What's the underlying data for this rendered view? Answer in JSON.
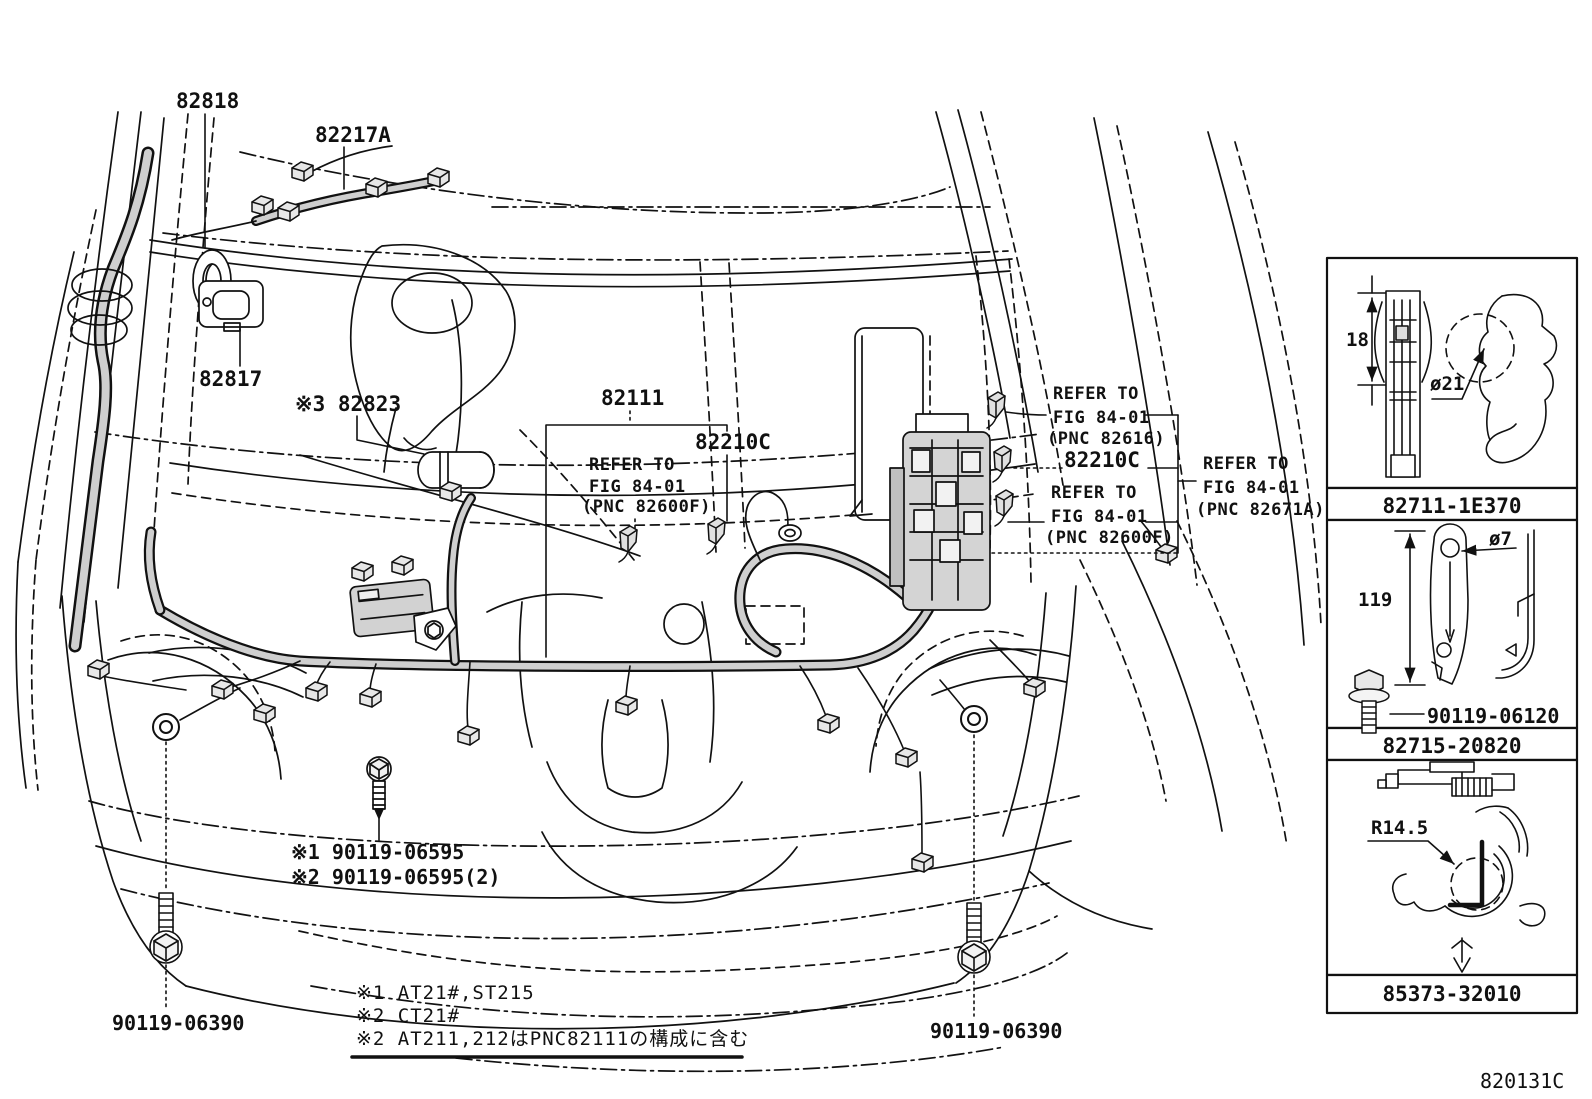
{
  "page": {
    "code": "820131C"
  },
  "callouts": {
    "grommet": "82818",
    "sub_harness": "82217A",
    "protector": "82817",
    "clamp_3": "※3 82823",
    "engine_harness": "82111",
    "clamp_mid": "82210C"
  },
  "refer_center": {
    "line1": "REFER TO",
    "line2": "FIG 84-01",
    "line3": "(PNC 82600F)"
  },
  "refer_right": {
    "top": {
      "line1": "REFER TO",
      "line2": "FIG 84-01",
      "line3": "(PNC 82616)"
    },
    "part": "82210C",
    "bottom": {
      "line1": "REFER TO",
      "line2": "FIG 84-01",
      "line3": "(PNC 82600F)"
    },
    "outer": {
      "line1": "REFER TO",
      "line2": "FIG 84-01",
      "line3": "(PNC 82671A)"
    }
  },
  "fasteners": {
    "note1": "※1 90119-06595",
    "note2": "※2 90119-06595(2)",
    "ground_left": "90119-06390",
    "ground_right": "90119-06390"
  },
  "footnotes": {
    "f1": "※1 AT21#,ST215",
    "f2": "※2 CT21#",
    "f3": "※2 AT211,212はPNC82111の構成に含む"
  },
  "side_panel": {
    "boxes": [
      {
        "part_no": "82711-1E370",
        "dim_height": "18",
        "dim_dia": "ø21"
      },
      {
        "part_no": "82715-20820",
        "dim_length": "119",
        "dim_dia": "ø7",
        "bolt": "90119-06120"
      },
      {
        "part_no": "85373-32010",
        "dim_radius": "R14.5"
      }
    ]
  }
}
